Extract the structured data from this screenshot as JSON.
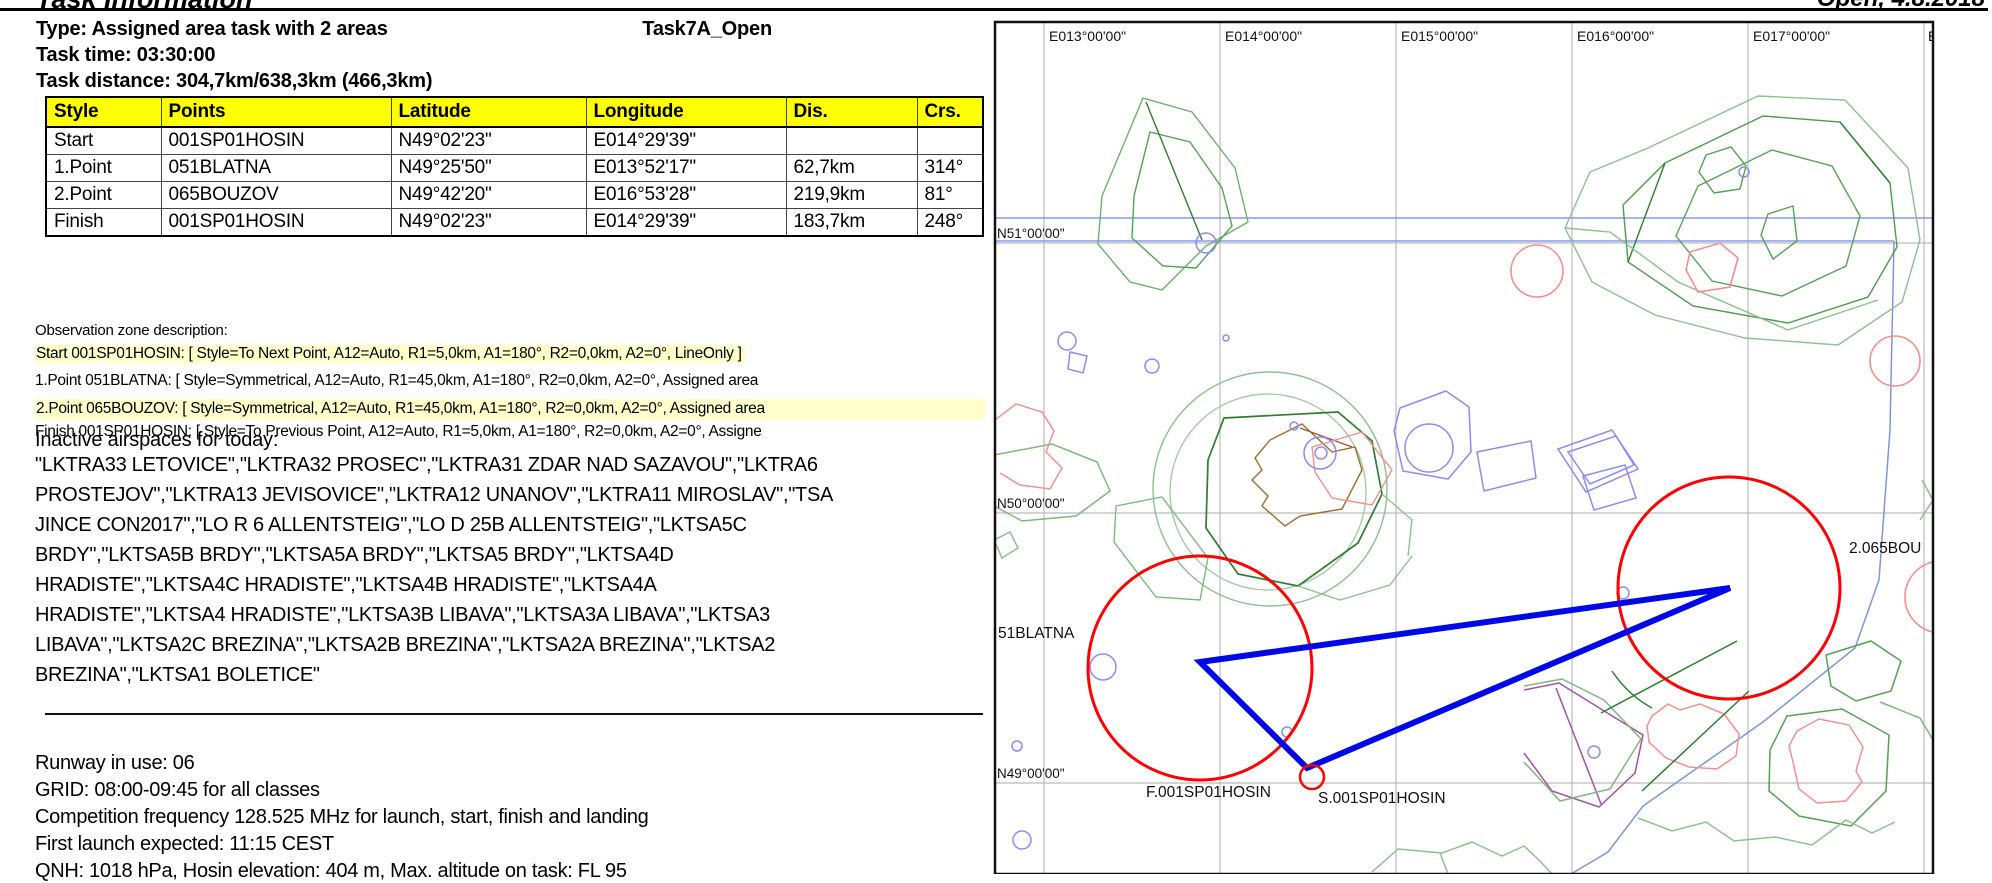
{
  "header": {
    "title": "Task Information",
    "edition": "Open, 4.8.2018"
  },
  "task": {
    "type_line": "Type: Assigned area task with 2 areas",
    "name": "Task7A_Open",
    "time_line": "Task time: 03:30:00",
    "distance_line": "Task distance: 304,7km/638,3km (466,3km)"
  },
  "table": {
    "headers": [
      "Style",
      "Points",
      "Latitude",
      "Longitude",
      "Dis.",
      "Crs."
    ],
    "rows": [
      {
        "style": "Start",
        "point": "001SP01HOSIN",
        "lat": "N49°02'23\"",
        "lon": "E014°29'39\"",
        "dis": "",
        "crs": ""
      },
      {
        "style": "1.Point",
        "point": "051BLATNA",
        "lat": "N49°25'50\"",
        "lon": "E013°52'17\"",
        "dis": "62,7km",
        "crs": "314°"
      },
      {
        "style": "2.Point",
        "point": "065BOUZOV",
        "lat": "N49°42'20\"",
        "lon": "E016°53'28\"",
        "dis": "219,9km",
        "crs": "81°"
      },
      {
        "style": "Finish",
        "point": "001SP01HOSIN",
        "lat": "N49°02'23\"",
        "lon": "E014°29'39\"",
        "dis": "183,7km",
        "crs": "248°"
      }
    ]
  },
  "observation": {
    "heading": "Observation zone description:",
    "lines": [
      {
        "text": "Start 001SP01HOSIN: [ Style=To Next Point, A12=Auto, R1=5,0km, A1=180°, R2=0,0km, A2=0°, LineOnly ]",
        "highlight": true
      },
      {
        "text": "1.Point 051BLATNA: [ Style=Symmetrical, A12=Auto, R1=45,0km, A1=180°, R2=0,0km, A2=0°, Assigned area",
        "highlight": false
      },
      {
        "text": "2.Point 065BOUZOV: [ Style=Symmetrical, A12=Auto, R1=45,0km, A1=180°, R2=0,0km, A2=0°, Assigned area",
        "highlight": true
      },
      {
        "text": "Finish 001SP01HOSIN: [ Style=To Previous Point, A12=Auto, R1=5,0km, A1=180°, R2=0,0km, A2=0°, Assigne",
        "highlight": false
      }
    ]
  },
  "airspaces": {
    "heading": "Inactive airspaces for today:",
    "text": "\"LKTRA33 LETOVICE\",\"LKTRA32 PROSEC\",\"LKTRA31 ZDAR NAD SAZAVOU\",\"LKTRA6\nPROSTEJOV\",\"LKTRA13 JEVISOVICE\",\"LKTRA12 UNANOV\",\"LKTRA11 MIROSLAV\",\"TSA\nJINCE CON2017\",\"LO R 6 ALLENTSTEIG\",\"LO D 25B ALLENTSTEIG\",\"LKTSA5C\nBRDY\",\"LKTSA5B BRDY\",\"LKTSA5A BRDY\",\"LKTSA5 BRDY\",\"LKTSA4D\nHRADISTE\",\"LKTSA4C HRADISTE\",\"LKTSA4B HRADISTE\",\"LKTSA4A\nHRADISTE\",\"LKTSA4 HRADISTE\",\"LKTSA3B LIBAVA\",\"LKTSA3A LIBAVA\",\"LKTSA3\nLIBAVA\",\"LKTSA2C BREZINA\",\"LKTSA2B BREZINA\",\"LKTSA2A BREZINA\",\"LKTSA2\nBREZINA\",\"LKTSA1 BOLETICE\""
  },
  "briefing": {
    "lines": [
      "Runway in use: 06",
      "GRID: 08:00-09:45 for all classes",
      "Competition frequency 128.525 MHz for launch, start, finish and landing",
      "First launch expected: 11:15 CEST",
      "QNH: 1018 hPa, Hosin elevation: 404 m, Max. altitude on task: FL 95"
    ]
  },
  "map": {
    "lon_labels": [
      "E013°00'00\"",
      "E014°00'00\"",
      "E015°00'00\"",
      "E016°00'00\"",
      "E017°00'00\"",
      "E"
    ],
    "lat_labels": [
      "N51°00'00\"",
      "N50°00'00\"",
      "N49°00'00\""
    ],
    "labels": {
      "point1": "51BLATNA",
      "point2": "2.065BOU",
      "finish": "F.001SP01HOSIN",
      "start": "S.001SP01HOSIN"
    },
    "colors": {
      "task_line": "#0008e8",
      "zone_circle": "#ff0000",
      "airspace_green_light": "#8fbf8f",
      "airspace_green_mid": "#55a055",
      "airspace_green_dark": "#2f7d2f",
      "airspace_red": "#f09090",
      "airspace_blue": "#8c8cf0",
      "airspace_brown": "#97702f",
      "airspace_magenta": "#a352a3",
      "boundary_blue": "#8899ee",
      "grid": "#bbbbbb"
    }
  }
}
